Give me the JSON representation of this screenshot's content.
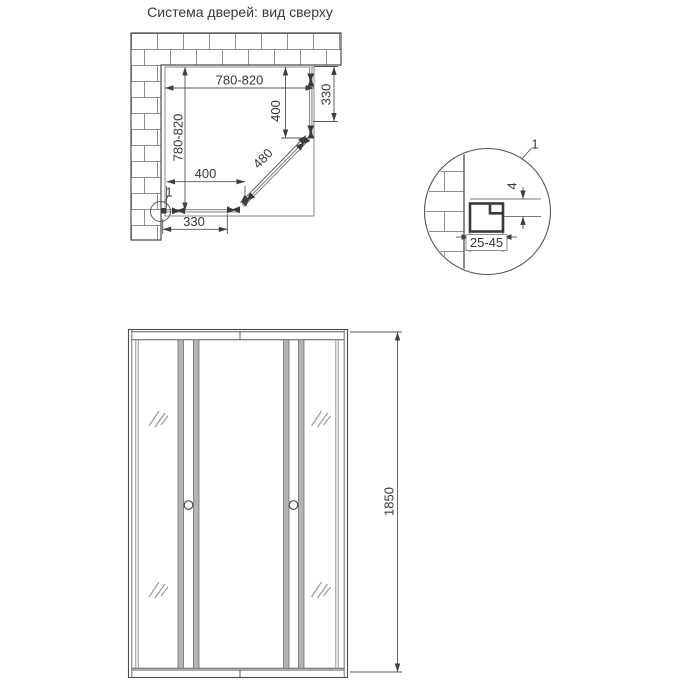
{
  "title": "Система дверей: вид сверху",
  "colors": {
    "line": "#4d4d4d",
    "thin_line": "#777777",
    "dim_line": "#555555",
    "brick_line": "#8f8f8f",
    "stile_fill": "#b4b4b4",
    "glass_line": "#6f6f6f",
    "profile_dark": "#3a3a3a"
  },
  "top_view": {
    "dim_width": "780-820",
    "dim_depth": "780-820",
    "dim_side_panel": "400",
    "dim_side_fixed": "330",
    "dim_front_panel": "400",
    "dim_front_fixed": "330",
    "dim_diagonal_door": "480",
    "detail_callout": "1"
  },
  "detail_view": {
    "callout": "1",
    "dim_profile_range": "25-45",
    "dim_glass_step": "4"
  },
  "front_view": {
    "dim_height": "1850"
  }
}
